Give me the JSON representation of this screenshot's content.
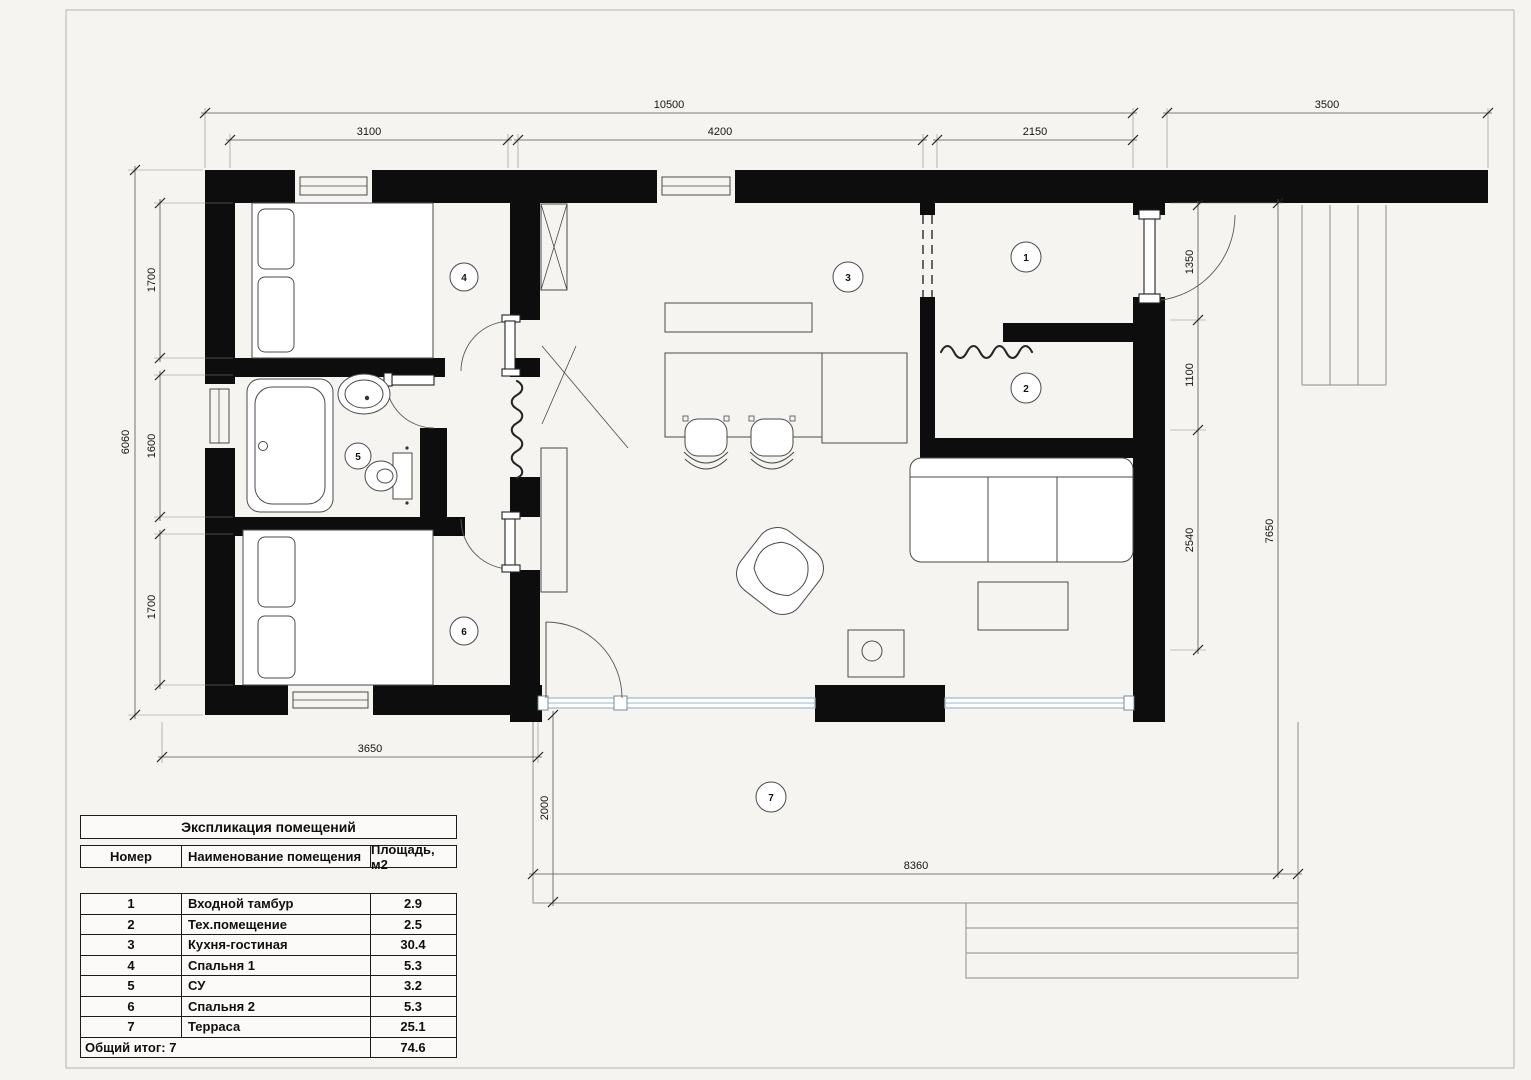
{
  "colors": {
    "wall": "#0d0d0d",
    "line": "#4a4a4a",
    "glazing": "#9db8c4",
    "paper": "#f5f4f1"
  },
  "dimensions": {
    "top_overall": "10500",
    "top_right": "3500",
    "top_seg1": "3100",
    "top_seg2": "4200",
    "top_seg3": "2150",
    "left_overall": "6060",
    "left_seg1": "1700",
    "left_seg2": "1600",
    "left_seg3": "1700",
    "right_seg1": "1350",
    "right_seg2": "1100",
    "right_seg3": "2540",
    "right_overall": "7650",
    "bottom_bedrooms": "3650",
    "terrace_depth": "2000",
    "terrace_width": "8360"
  },
  "rooms": [
    {
      "number": "1",
      "name": "Входной тамбур",
      "area": "2.9"
    },
    {
      "number": "2",
      "name": "Тех.помещение",
      "area": "2.5"
    },
    {
      "number": "3",
      "name": "Кухня-гостиная",
      "area": "30.4"
    },
    {
      "number": "4",
      "name": "Спальня 1",
      "area": "5.3"
    },
    {
      "number": "5",
      "name": "СУ",
      "area": "3.2"
    },
    {
      "number": "6",
      "name": "Спальня 2",
      "area": "5.3"
    },
    {
      "number": "7",
      "name": "Терраса",
      "area": "25.1"
    }
  ],
  "legend": {
    "title": "Экспликация помещений",
    "col_number": "Номер",
    "col_name": "Наименование помещения",
    "col_area": "Площадь, м2",
    "total_label": "Общий итог: 7",
    "total_value": "74.6"
  }
}
